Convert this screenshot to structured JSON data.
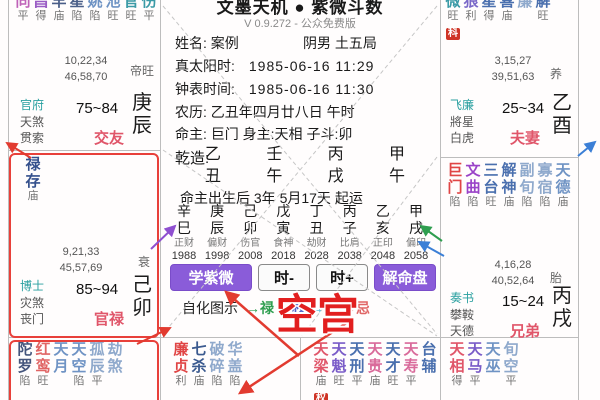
{
  "app": {
    "title": "文墨天机 ● 紫微斗数",
    "version": "V 0.9.272 - 公众免费版"
  },
  "info": {
    "name": "姓名: 案例",
    "gender_bureau": "阴男 土五局",
    "solar_label": "真太阳时:",
    "solar_value": "1985-06-16  11:29",
    "clock_label": "钟表时间:",
    "clock_value": "1985-06-16  11:30",
    "lunar": "农历: 乙丑年四月廿八日 午时",
    "masters": "命主: 巨门 身主:天相  子斗:卯",
    "qianzao_label": "乾造:",
    "qiyun": "命主出生后 3年 5月17天 起运"
  },
  "pillars": [
    {
      "stem": "乙",
      "branch": "丑"
    },
    {
      "stem": "壬",
      "branch": "午"
    },
    {
      "stem": "丙",
      "branch": "戌"
    },
    {
      "stem": "甲",
      "branch": "午"
    }
  ],
  "decades": [
    {
      "stem": "辛",
      "branch": "巳",
      "god": "正财",
      "year": "1988"
    },
    {
      "stem": "庚",
      "branch": "辰",
      "god": "偏财",
      "year": "1998"
    },
    {
      "stem": "己",
      "branch": "卯",
      "god": "伤官",
      "year": "2008"
    },
    {
      "stem": "戊",
      "branch": "寅",
      "god": "食神",
      "year": "2018"
    },
    {
      "stem": "丁",
      "branch": "丑",
      "god": "劫财",
      "year": "2028"
    },
    {
      "stem": "丙",
      "branch": "子",
      "god": "比肩",
      "year": "2038"
    },
    {
      "stem": "乙",
      "branch": "亥",
      "god": "正印",
      "year": "2048"
    },
    {
      "stem": "甲",
      "branch": "戌",
      "god": "偏印",
      "year": "2058"
    }
  ],
  "buttons": {
    "learn": "学紫微",
    "hour_minus": "时-",
    "hour_plus": "时+",
    "decode": "解命盘"
  },
  "sihua_legend": {
    "label": "自化图示",
    "items": [
      {
        "text": "→禄",
        "color": "#2e9e4f"
      },
      {
        "text": "→权",
        "color": "#4f63c8"
      },
      {
        "text": "→科",
        "color": "#3fb6d8"
      },
      {
        "text": "→忌",
        "color": "#e06666"
      }
    ]
  },
  "annotation": {
    "empty_palace": "空宫"
  },
  "palaces": [
    {
      "id": "chen",
      "palace_name": "交友",
      "stem": "庚",
      "branch": "辰",
      "age_range": "75~84",
      "life_stage": "帝旺",
      "numbers": [
        "10,22,34",
        "46,58,70"
      ],
      "gods": [
        "官府",
        "天煞",
        "贯索"
      ],
      "stars": [
        {
          "c": "天同",
          "b": "平",
          "color": "#bf62b8"
        },
        {
          "c": "文昌",
          "b": "得",
          "color": "#9a5cc4"
        },
        {
          "c": "擎羊",
          "b": "庙",
          "color": "#4a5e88"
        },
        {
          "c": "火星",
          "b": "陷",
          "color": "#4a5e88"
        },
        {
          "c": "天姚",
          "b": "陷",
          "color": "#6f93c4"
        },
        {
          "c": "咸池",
          "b": "旺",
          "color": "#6f93c4"
        },
        {
          "c": "天官",
          "b": "旺",
          "color": "#3b9aa6"
        },
        {
          "c": "天伤",
          "b": "平",
          "color": "#3b9aa6"
        }
      ]
    },
    {
      "id": "mao",
      "palace_name": "官禄",
      "stem": "己",
      "branch": "卯",
      "age_range": "85~94",
      "life_stage": "衰",
      "numbers": [
        "9,21,33",
        "45,57,69"
      ],
      "gods": [
        "博士",
        "灾煞",
        "丧门"
      ],
      "stars": [
        {
          "c": "禄存",
          "b": "庙",
          "color": "#34508c"
        }
      ]
    },
    {
      "id": "yin",
      "stars": [
        {
          "c": "陀罗",
          "b": "陷",
          "color": "#44557c"
        },
        {
          "c": "红鸾",
          "b": "旺",
          "color": "#e06565"
        },
        {
          "c": "天月",
          "b": "",
          "color": "#6f93c4"
        },
        {
          "c": "天空",
          "b": "陷",
          "color": "#6f93c4"
        },
        {
          "c": "孤辰",
          "b": "平",
          "color": "#8fa9cc"
        },
        {
          "c": "劫煞",
          "b": "",
          "color": "#8fa9cc"
        }
      ]
    },
    {
      "id": "chou",
      "stars": [
        {
          "c": "廉贞",
          "b": "利",
          "color": "#e04545"
        },
        {
          "c": "七杀",
          "b": "庙",
          "color": "#3b5a8f"
        },
        {
          "c": "破碎",
          "b": "陷",
          "color": "#8fa9cc"
        },
        {
          "c": "华盖",
          "b": "陷",
          "color": "#8fa9cc"
        }
      ]
    },
    {
      "id": "zi",
      "stars": [
        {
          "c": "天梁",
          "b": "庙",
          "color": "#e0566a",
          "badge": "权"
        },
        {
          "c": "天魁",
          "b": "旺",
          "color": "#7a5cc8"
        },
        {
          "c": "天刑",
          "b": "平",
          "color": "#4a6fae"
        },
        {
          "c": "天贵",
          "b": "庙",
          "color": "#d96a9a"
        },
        {
          "c": "天才",
          "b": "旺",
          "color": "#4a6fae"
        },
        {
          "c": "天寿",
          "b": "平",
          "color": "#d96a9a"
        },
        {
          "c": "台辅",
          "b": "",
          "color": "#4a6fae"
        }
      ]
    },
    {
      "id": "hai",
      "stars": [
        {
          "c": "天相",
          "b": "得",
          "color": "#e0566a"
        },
        {
          "c": "天马",
          "b": "平",
          "color": "#7a5cc8"
        },
        {
          "c": "天巫",
          "b": "",
          "color": "#6f93c4"
        },
        {
          "c": "旬空",
          "b": "平",
          "color": "#8fa9cc"
        }
      ]
    },
    {
      "id": "you",
      "palace_name": "夫妻",
      "stem": "乙",
      "branch": "酉",
      "age_range": "25~34",
      "life_stage": "养",
      "numbers": [
        "3,15,27",
        "39,51,63"
      ],
      "gods": [
        "飞廉",
        "將星",
        "白虎"
      ],
      "stars": [
        {
          "c": "紫微",
          "b": "旺",
          "color": "#3b9aa6",
          "badge": "科"
        },
        {
          "c": "贪狼",
          "b": "利",
          "color": "#7a68c8"
        },
        {
          "c": "铃星",
          "b": "得",
          "color": "#4a6fae"
        },
        {
          "c": "天喜",
          "b": "庙",
          "color": "#4a6fae"
        },
        {
          "c": "蜚廉",
          "b": "",
          "color": "#8fa9cc"
        },
        {
          "c": "年解",
          "b": "旺",
          "color": "#4a6fae"
        }
      ]
    },
    {
      "id": "xu",
      "palace_name": "兄弟",
      "stem": "丙",
      "branch": "戌",
      "age_range": "15~24",
      "life_stage": "胎",
      "numbers": [
        "4,16,28",
        "40,52,64"
      ],
      "gods": [
        "奏书",
        "攀鞍",
        "天德"
      ],
      "stars": [
        {
          "c": "巨门",
          "b": "陷",
          "color": "#e04545"
        },
        {
          "c": "文曲",
          "b": "陷",
          "color": "#9a43c8"
        },
        {
          "c": "三台",
          "b": "旺",
          "color": "#4a6fae"
        },
        {
          "c": "解神",
          "b": "庙",
          "color": "#4a6fae"
        },
        {
          "c": "副旬",
          "b": "陷",
          "color": "#8fa9cc"
        },
        {
          "c": "寡宿",
          "b": "陷",
          "color": "#8fa9cc"
        },
        {
          "c": "天德",
          "b": "庙",
          "color": "#6f93c4"
        }
      ]
    }
  ]
}
